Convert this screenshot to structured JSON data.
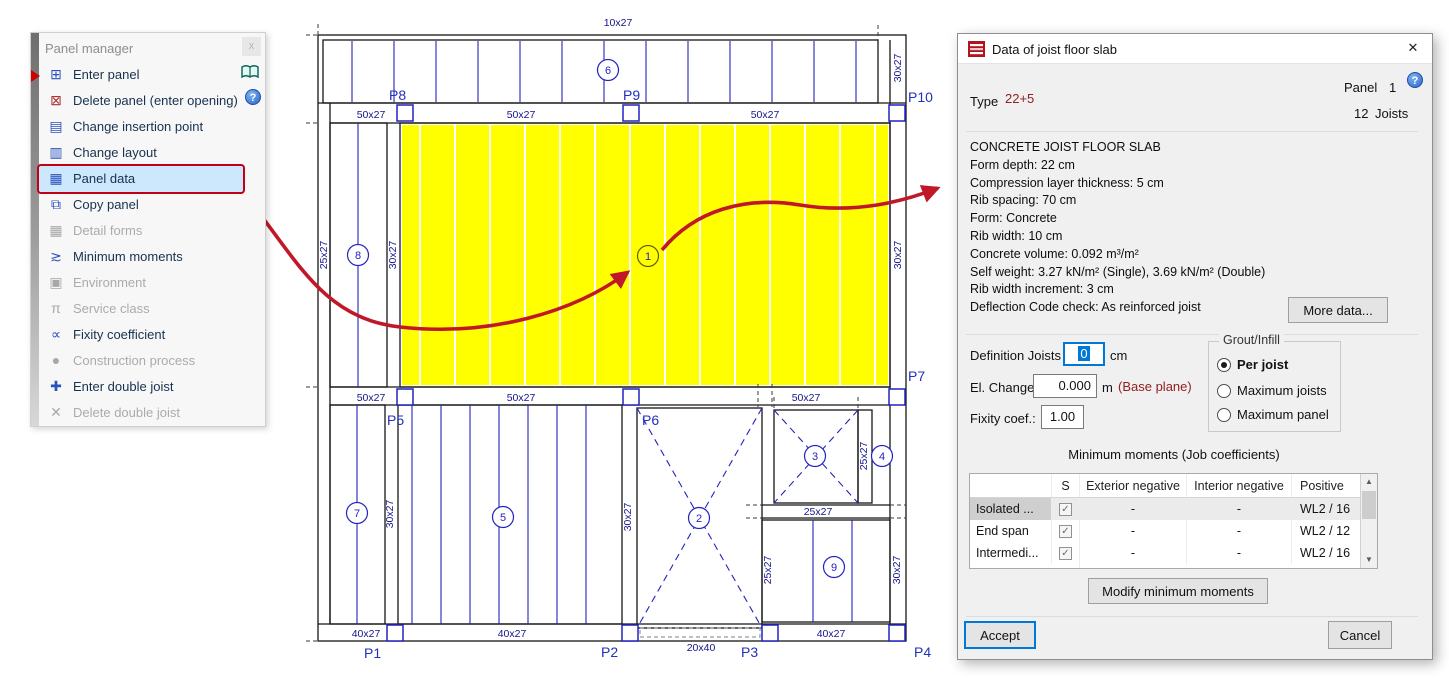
{
  "colors": {
    "highlight_panel": "#ffff00",
    "menu_highlight_bg": "#cde8fd",
    "menu_highlight_border": "#c00017",
    "arrow_red": "#c01828",
    "accent_blue": "#0078d7",
    "plan_line_blue": "#2323c0",
    "dim_text_navy": "#14148c",
    "maroon_text": "#8f2024"
  },
  "panel_manager": {
    "title": "Panel manager",
    "close_button": "x",
    "items": [
      {
        "label": "Enter panel",
        "glyph": "⊞",
        "enabled": true
      },
      {
        "label": "Delete panel (enter opening)",
        "glyph": "⊠",
        "enabled": true
      },
      {
        "label": "Change insertion point",
        "glyph": "▤",
        "enabled": true
      },
      {
        "label": "Change layout",
        "glyph": "▥",
        "enabled": true
      },
      {
        "label": "Panel data",
        "glyph": "▦",
        "enabled": true,
        "highlighted": true
      },
      {
        "label": "Copy panel",
        "glyph": "⧉",
        "enabled": true
      },
      {
        "label": "Detail forms",
        "glyph": "▦",
        "enabled": false
      },
      {
        "label": "Minimum moments",
        "glyph": "≳",
        "enabled": true
      },
      {
        "label": "Environment",
        "glyph": "▣",
        "enabled": false
      },
      {
        "label": "Service class",
        "glyph": "π",
        "enabled": false
      },
      {
        "label": "Fixity coefficient",
        "glyph": "∝",
        "enabled": true
      },
      {
        "label": "Construction process",
        "glyph": "●",
        "enabled": false
      },
      {
        "label": "Enter double joist",
        "glyph": "✚",
        "enabled": true
      },
      {
        "label": "Delete double joist",
        "glyph": "✕",
        "enabled": false
      }
    ]
  },
  "dialog": {
    "title": "Data of joist floor slab",
    "close": "✕",
    "help": "?",
    "type_label": "Type",
    "type_value": "22+5",
    "panel_label": "Panel",
    "panel_number": "1",
    "joists_count": "12",
    "joists_label": "Joists",
    "info_lines": [
      "CONCRETE JOIST FLOOR SLAB",
      "Form depth: 22 cm",
      "Compression layer thickness: 5 cm",
      "Rib spacing: 70 cm",
      "Form: Concrete",
      "Rib width: 10 cm",
      "Concrete volume: 0.092 m³/m²",
      "Self weight: 3.27 kN/m² (Single), 3.69 kN/m² (Double)",
      "Rib width increment: 3 cm",
      "Deflection Code check: As reinforced joist"
    ],
    "more_data_button": "More data...",
    "definition_label": "Definition Joists",
    "definition_value": "0",
    "definition_unit": "cm",
    "el_change_label": "El. Change",
    "el_change_value": "0.000",
    "el_change_unit": "m",
    "el_change_note": "(Base plane)",
    "fixity_label": "Fixity coef.:",
    "fixity_value": "1.00",
    "grout_title": "Grout/Infill",
    "grout_options": [
      {
        "label": "Per joist",
        "selected": true
      },
      {
        "label": "Maximum joists",
        "selected": false
      },
      {
        "label": "Maximum panel",
        "selected": false
      }
    ],
    "moments_title": "Minimum moments (Job coefficients)",
    "table": {
      "col_name": "",
      "col_s": "S",
      "col_ext": "Exterior negative",
      "col_int": "Interior negative",
      "col_pos": "Positive",
      "check_glyph": "✓",
      "rows": [
        {
          "name": "Isolated ...",
          "ext": "-",
          "int": "-",
          "pos": "WL2 / 16"
        },
        {
          "name": "End span",
          "ext": "-",
          "int": "-",
          "pos": "WL2 / 12"
        },
        {
          "name": "Intermedi...",
          "ext": "-",
          "int": "-",
          "pos": "WL2 / 16"
        }
      ]
    },
    "modify_button": "Modify minimum moments",
    "accept_button": "Accept",
    "cancel_button": "Cancel"
  },
  "plan": {
    "dim_labels": [
      {
        "text": "10x27"
      },
      {
        "text": "50x27"
      },
      {
        "text": "50x27"
      },
      {
        "text": "50x27"
      },
      {
        "text": "30x27"
      },
      {
        "text": "25x27"
      },
      {
        "text": "30x27"
      },
      {
        "text": "30x27"
      },
      {
        "text": "50x27"
      },
      {
        "text": "50x27"
      },
      {
        "text": "50x27"
      },
      {
        "text": "30x27"
      },
      {
        "text": "30x27"
      },
      {
        "text": "25x27"
      },
      {
        "text": "25x27"
      },
      {
        "text": "25x27"
      },
      {
        "text": "30x27"
      },
      {
        "text": "40x27"
      },
      {
        "text": "40x27"
      },
      {
        "text": "20x40"
      },
      {
        "text": "40x27"
      }
    ],
    "column_labels": [
      {
        "text": "P1"
      },
      {
        "text": "P2"
      },
      {
        "text": "P3"
      },
      {
        "text": "P4"
      },
      {
        "text": "P5"
      },
      {
        "text": "P6"
      },
      {
        "text": "P7"
      },
      {
        "text": "P8"
      },
      {
        "text": "P9"
      },
      {
        "text": "P10"
      }
    ],
    "panel_numbers": [
      {
        "n": "1"
      },
      {
        "n": "2"
      },
      {
        "n": "3"
      },
      {
        "n": "4"
      },
      {
        "n": "5"
      },
      {
        "n": "6"
      },
      {
        "n": "7"
      },
      {
        "n": "8"
      },
      {
        "n": "9"
      }
    ]
  }
}
